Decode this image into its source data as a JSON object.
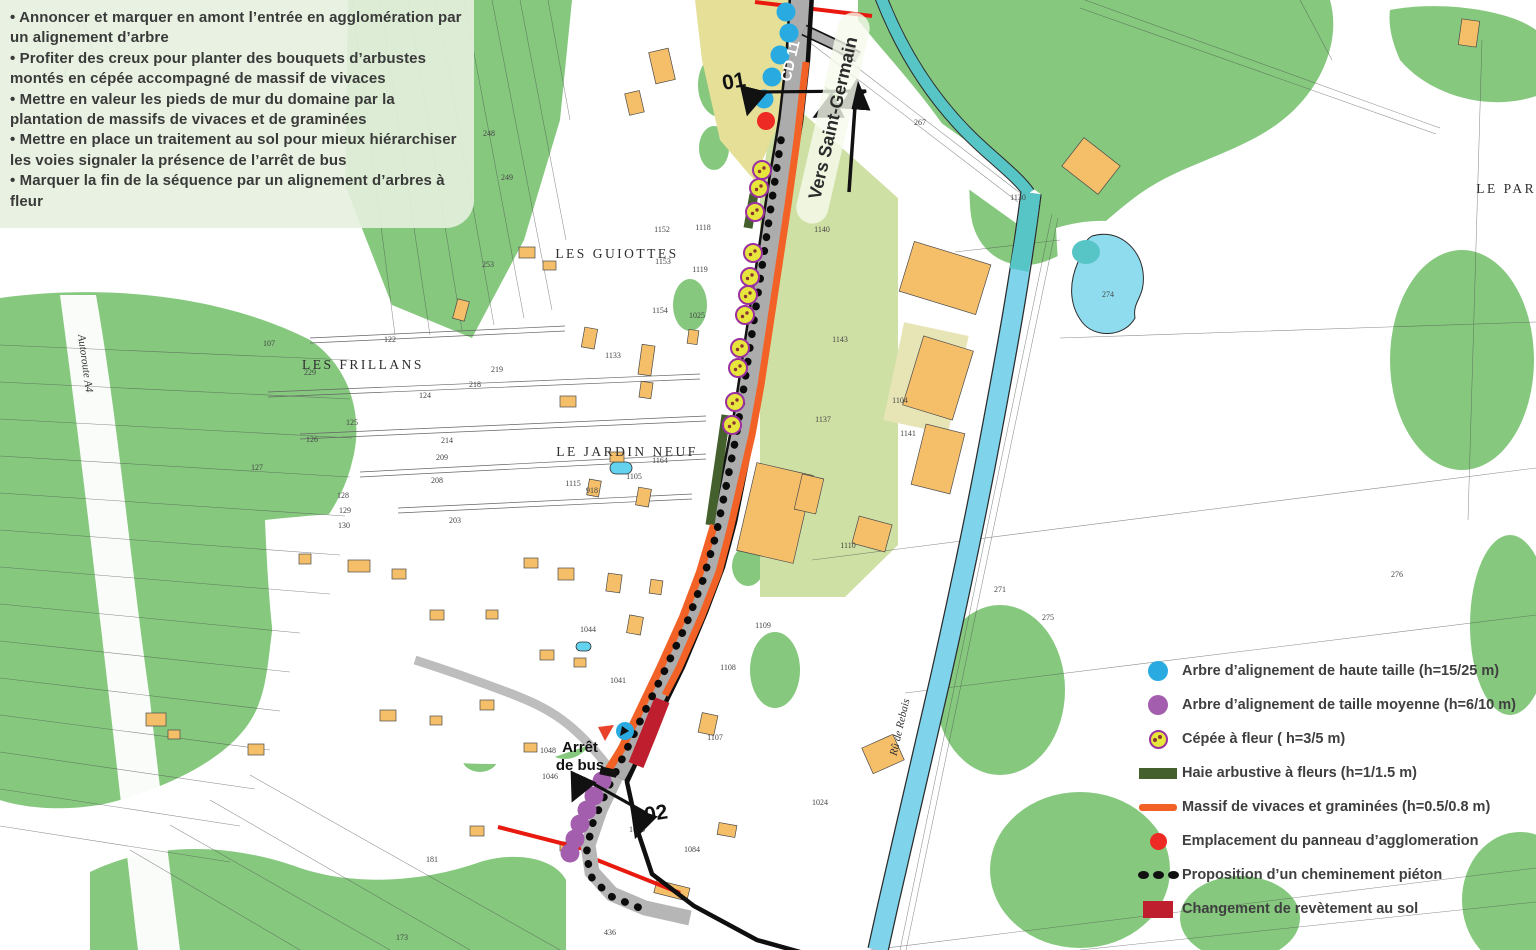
{
  "annotation_panel": {
    "bullets": [
      "Annoncer et marquer en amont l’entrée en agglomération par un alignement d’arbre",
      "Profiter des creux pour planter des bouquets d’arbustes montés en cépée accompagné de massif de vivaces",
      "Mettre en valeur les pieds de mur du domaine par la plantation de massifs de vivaces et de graminées",
      "Mettre en place un traitement au sol pour mieux hiérarchiser les voies signaler la présence de l’arrêt de bus",
      "Marquer la fin de la séquence par un alignement d’arbres à fleur"
    ]
  },
  "map_labels": {
    "road": "CD 11",
    "direction": "Vers Saint-Germain",
    "point_01": "01",
    "point_02": "02",
    "bus_stop_line1": "Arrêt",
    "bus_stop_line2": "de bus",
    "place_guiottes": "LES GUIOTTES",
    "place_frillans": "LES FRILLANS",
    "place_jardin_neuf": "LE JARDIN NEUF",
    "place_parc": "LE PARC",
    "stream": "Rû de Rebais",
    "autoroute": "Autoroute A4"
  },
  "parcel_numbers": [
    {
      "n": "267",
      "x": 920,
      "y": 125
    },
    {
      "n": "1130",
      "x": 1018,
      "y": 200
    },
    {
      "n": "274",
      "x": 1108,
      "y": 297
    },
    {
      "n": "1140",
      "x": 822,
      "y": 232
    },
    {
      "n": "1143",
      "x": 840,
      "y": 342
    },
    {
      "n": "1104",
      "x": 900,
      "y": 403
    },
    {
      "n": "1141",
      "x": 908,
      "y": 436
    },
    {
      "n": "1137",
      "x": 823,
      "y": 422
    },
    {
      "n": "1110",
      "x": 848,
      "y": 548
    },
    {
      "n": "276",
      "x": 1397,
      "y": 577
    },
    {
      "n": "271",
      "x": 1000,
      "y": 592
    },
    {
      "n": "275",
      "x": 1048,
      "y": 620
    },
    {
      "n": "1109",
      "x": 763,
      "y": 628
    },
    {
      "n": "1108",
      "x": 728,
      "y": 670
    },
    {
      "n": "1118",
      "x": 703,
      "y": 230
    },
    {
      "n": "1152",
      "x": 662,
      "y": 232
    },
    {
      "n": "1153",
      "x": 663,
      "y": 264
    },
    {
      "n": "1154",
      "x": 660,
      "y": 313
    },
    {
      "n": "1119",
      "x": 700,
      "y": 272
    },
    {
      "n": "1025",
      "x": 697,
      "y": 318
    },
    {
      "n": "1133",
      "x": 613,
      "y": 358
    },
    {
      "n": "1115",
      "x": 573,
      "y": 486
    },
    {
      "n": "918",
      "x": 592,
      "y": 493
    },
    {
      "n": "1164",
      "x": 660,
      "y": 463
    },
    {
      "n": "1105",
      "x": 634,
      "y": 479
    },
    {
      "n": "1044",
      "x": 588,
      "y": 632
    },
    {
      "n": "1046",
      "x": 550,
      "y": 779
    },
    {
      "n": "1048",
      "x": 548,
      "y": 753
    },
    {
      "n": "1041",
      "x": 618,
      "y": 683
    },
    {
      "n": "1024",
      "x": 820,
      "y": 805
    },
    {
      "n": "1084",
      "x": 692,
      "y": 852
    },
    {
      "n": "1085",
      "x": 637,
      "y": 832
    },
    {
      "n": "1107",
      "x": 715,
      "y": 740
    },
    {
      "n": "436",
      "x": 610,
      "y": 935
    },
    {
      "n": "173",
      "x": 402,
      "y": 940
    },
    {
      "n": "181",
      "x": 432,
      "y": 862
    },
    {
      "n": "107",
      "x": 269,
      "y": 346
    },
    {
      "n": "122",
      "x": 390,
      "y": 342
    },
    {
      "n": "124",
      "x": 425,
      "y": 398
    },
    {
      "n": "125",
      "x": 352,
      "y": 425
    },
    {
      "n": "126",
      "x": 312,
      "y": 442
    },
    {
      "n": "127",
      "x": 257,
      "y": 470
    },
    {
      "n": "128",
      "x": 343,
      "y": 498
    },
    {
      "n": "129",
      "x": 345,
      "y": 513
    },
    {
      "n": "130",
      "x": 344,
      "y": 528
    },
    {
      "n": "218",
      "x": 475,
      "y": 387
    },
    {
      "n": "219",
      "x": 497,
      "y": 372
    },
    {
      "n": "214",
      "x": 447,
      "y": 443
    },
    {
      "n": "209",
      "x": 442,
      "y": 460
    },
    {
      "n": "208",
      "x": 437,
      "y": 483
    },
    {
      "n": "203",
      "x": 455,
      "y": 523
    },
    {
      "n": "248",
      "x": 489,
      "y": 136
    },
    {
      "n": "249",
      "x": 507,
      "y": 180
    },
    {
      "n": "253",
      "x": 488,
      "y": 267
    },
    {
      "n": "229",
      "x": 310,
      "y": 375
    }
  ],
  "markers": {
    "blue_trees": [
      [
        786,
        12
      ],
      [
        789,
        33
      ],
      [
        780,
        55
      ],
      [
        772,
        77
      ],
      [
        764,
        99
      ]
    ],
    "panneau_agglomeration": [
      766,
      121
    ],
    "cepees": [
      [
        762,
        170
      ],
      [
        759,
        188
      ],
      [
        755,
        212
      ],
      [
        753,
        253
      ],
      [
        750,
        277
      ],
      [
        748,
        295
      ],
      [
        745,
        315
      ],
      [
        740,
        348
      ],
      [
        738,
        368
      ],
      [
        735,
        402
      ],
      [
        732,
        425
      ]
    ],
    "purple_trees": [
      [
        602,
        781
      ],
      [
        594,
        796
      ],
      [
        587,
        810
      ],
      [
        580,
        824
      ],
      [
        575,
        839
      ],
      [
        570,
        853
      ]
    ],
    "bus_stop_point": [
      625,
      731
    ]
  },
  "legend": {
    "items": [
      {
        "key": "arbre-haute-taille",
        "color": "#29ABE2",
        "label": "Arbre d’alignement de haute taille (h=15/25 m)"
      },
      {
        "key": "arbre-taille-moyenne",
        "color": "#A35FAD",
        "label": "Arbre d’alignement de taille moyenne (h=6/10 m)"
      },
      {
        "key": "cepee-a-fleur",
        "color": "#E6E63C",
        "label": "Cépée à fleur ( h=3/5 m)"
      },
      {
        "key": "haie-arbustive",
        "color": "#44602C",
        "label": "Haie arbustive à fleurs (h=1/1.5 m)"
      },
      {
        "key": "massif-vivaces",
        "color": "#F26227",
        "label": "Massif de vivaces et graminées (h=0.5/0.8 m)"
      },
      {
        "key": "panneau-agglomeration",
        "color": "#EE2A24",
        "label": "Emplacement du panneau d’agglomeration"
      },
      {
        "key": "cheminement-pieton",
        "color": "#111111",
        "label": "Proposition d’un cheminement piéton"
      },
      {
        "key": "changement-revetement",
        "color": "#BE1E2D",
        "label": "Changement de revètement au sol"
      }
    ]
  },
  "colors": {
    "tree_high": "#29ABE2",
    "tree_medium": "#A35FAD",
    "cepee_fill": "#E6E63C",
    "cepee_ring": "#9B30A0",
    "cepee_dot": "#8A3434",
    "haie": "#44602C",
    "massif": "#F26227",
    "panneau": "#EE2A24",
    "cheminement": "#111111",
    "revetement": "#BE1E2D",
    "woodland": "#85C87E",
    "field_olive": "#CFE0A4",
    "field_khaki": "#E5DF97",
    "water": "#7FD4EC",
    "water_teal": "#57C4C6",
    "road": "#ACACAC"
  }
}
